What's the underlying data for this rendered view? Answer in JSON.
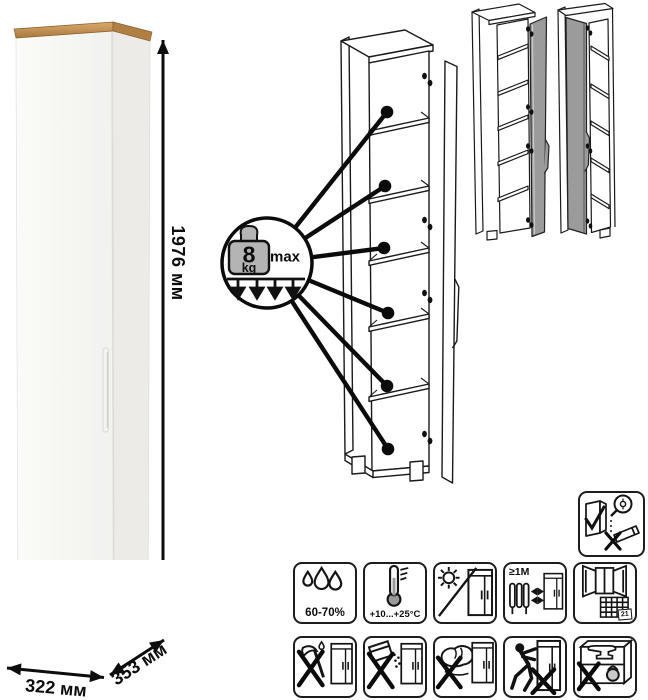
{
  "product": {
    "type": "tall-single-door-cabinet",
    "dimensions": {
      "height_label": "1976 мм",
      "width_label": "322 мм",
      "depth_label": "353 мм"
    },
    "shelf_load_badge": {
      "value": "8",
      "unit": "kg",
      "qualifier": "max",
      "applies_to_shelves": 6
    },
    "door_variants": [
      "door-hinged-right",
      "door-hinged-left"
    ]
  },
  "colors": {
    "background": "#ffffff",
    "wood_top_light": "#d9aa6c",
    "wood_top_dark": "#a97840",
    "cabinet_front": "#f8f8f5",
    "cabinet_side": "#ecebe7",
    "door_gray": "#9b9b9b",
    "line_art": "#1a1a1a",
    "foot_gray": "#c7c7c5"
  },
  "care_icons": [
    {
      "name": "humidity-range-icon",
      "label": "60-70%"
    },
    {
      "name": "temperature-range-icon",
      "label": "+10...+25°C"
    },
    {
      "name": "no-direct-sunlight-icon",
      "label": ""
    },
    {
      "name": "keep-distance-from-heat-icon",
      "label": "≥1M"
    },
    {
      "name": "ventilate-room-calendar-icon",
      "label": "21"
    },
    {
      "name": "no-sharp-impacts-icon",
      "label": ""
    },
    {
      "name": "no-spilling-liquids-icon",
      "label": ""
    },
    {
      "name": "no-abrasive-cleaning-icon",
      "label": ""
    },
    {
      "name": "do-not-drag-icon",
      "label": ""
    },
    {
      "name": "do-not-overload-icon",
      "label": ""
    }
  ],
  "assembly_icon": {
    "name": "assemble-upright-only-icon"
  }
}
